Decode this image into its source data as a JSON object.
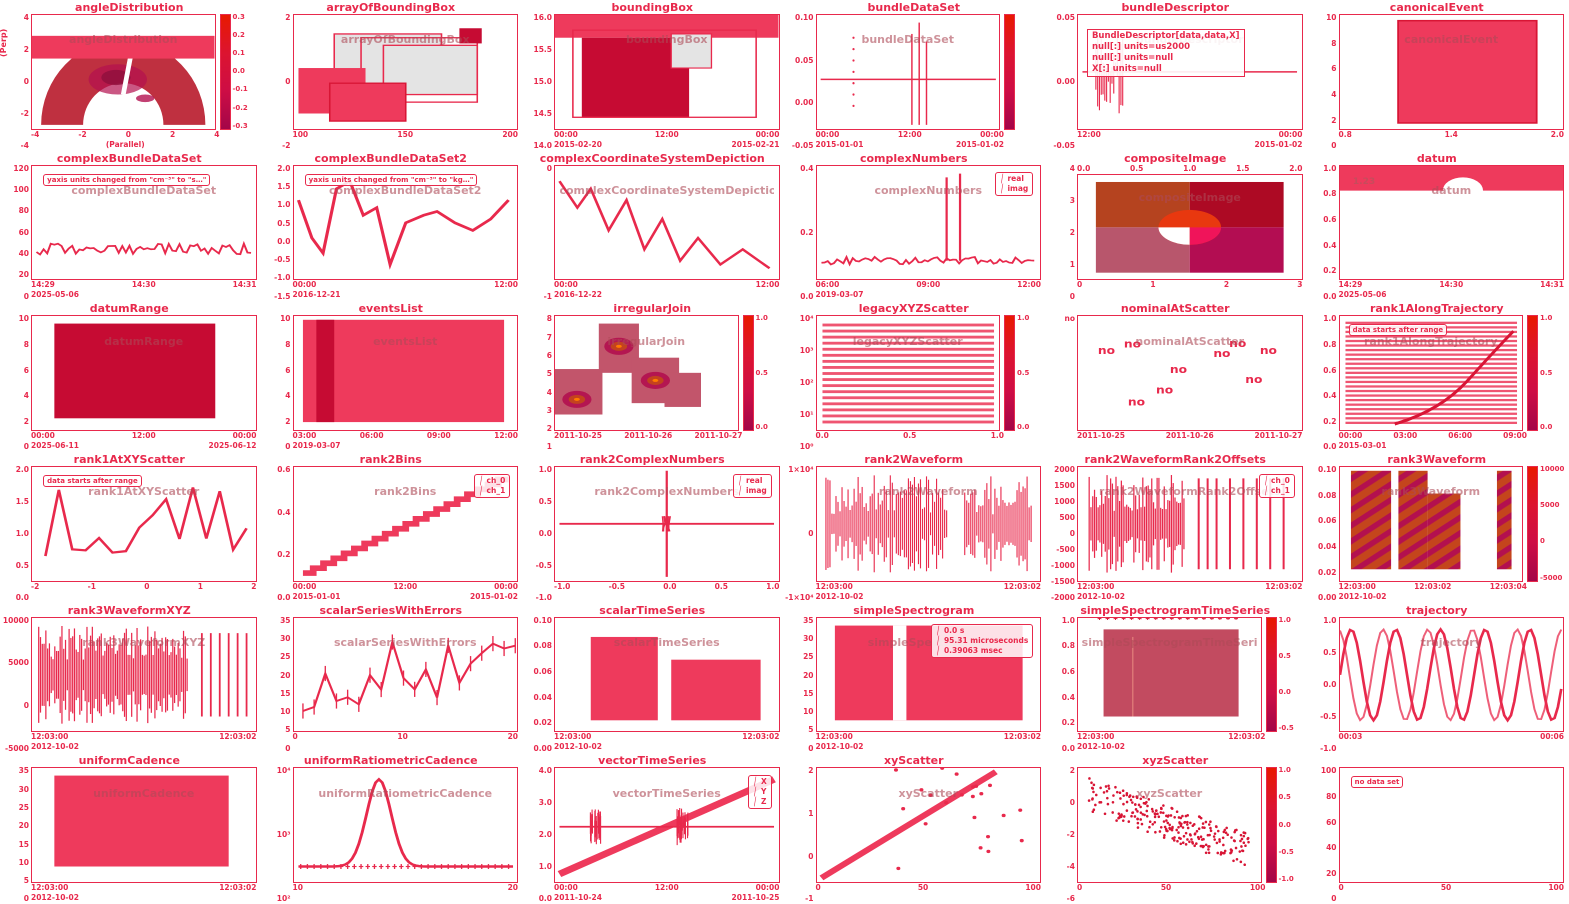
{
  "accent_color": "#e8294c",
  "dark_color": "#c60b33",
  "fill_color": "#ee3a5c",
  "chart_data": [
    {
      "title": "angleDistribution",
      "type": "polar-heatmap",
      "sketch": "fan",
      "ylabel": "(Perp)",
      "xlabel": "(Parallel)",
      "x_ticks": [
        "-4",
        "-2",
        "0",
        "2",
        "4"
      ],
      "y_ticks": [
        "4",
        "2",
        "0",
        "-2",
        "-4"
      ],
      "colorbar_ticks": [
        "0.3",
        "0.2",
        "0.1",
        "0.0",
        "-0.1",
        "-0.2",
        "-0.3"
      ]
    },
    {
      "title": "arrayOfBoundingBox",
      "type": "boxes",
      "sketch": "boxes",
      "x_ticks": [
        "100",
        "150",
        "200"
      ],
      "y_ticks": [
        "2",
        "0",
        "-2"
      ]
    },
    {
      "title": "boundingBox",
      "type": "boxes",
      "sketch": "boxes2",
      "x_ticks": [
        "00:00",
        "12:00",
        "00:00"
      ],
      "dates": [
        "2015-02-20",
        "",
        "2015-02-21"
      ],
      "y_ticks": [
        "16.0",
        "15.5",
        "15.0",
        "14.5",
        "14.0"
      ]
    },
    {
      "title": "bundleDataSet",
      "type": "line",
      "sketch": "flatspikes",
      "x_ticks": [
        "00:00",
        "12:00",
        "00:00"
      ],
      "dates": [
        "2015-01-01",
        "",
        "2015-01-02"
      ],
      "y_ticks": [
        "0.10",
        "0.05",
        "0.00",
        "-0.05"
      ],
      "colorbar_ticks": []
    },
    {
      "title": "bundleDescriptor",
      "type": "text",
      "sketch": "textbox",
      "x_ticks": [
        "12:00",
        "00:00"
      ],
      "dates": [
        "",
        "2015-01-02"
      ],
      "y_ticks": [
        "0.05",
        "0.00",
        "-0.05"
      ],
      "text_lines": [
        "BundleDescriptor[data,data,X]",
        "null[:] units=us2000",
        "null[:] units=null",
        "X[:] units=null"
      ]
    },
    {
      "title": "canonicalEvent",
      "type": "bar",
      "sketch": "bar",
      "x_ticks": [
        "0.8",
        "1.4",
        "2.0"
      ],
      "y_ticks": [
        "10",
        "8",
        "6",
        "4",
        "2",
        "0"
      ]
    },
    {
      "title": "complexBundleDataSet",
      "type": "line",
      "sketch": "noisyflat",
      "annotation": "yaxis units changed from \"cm⁻³\" to \"s…\"",
      "x_ticks": [
        "14:29",
        "14:30",
        "14:31"
      ],
      "dates": [
        "2025-05-06",
        "",
        ""
      ],
      "y_ticks": [
        "120",
        "100",
        "80",
        "60",
        "40",
        "20",
        "0"
      ]
    },
    {
      "title": "complexBundleDataSet2",
      "type": "line",
      "sketch": "zigzag",
      "annotation": "yaxis units changed from \"cm⁻³\" to \"kg…\"",
      "x_ticks": [
        "00:00",
        "12:00"
      ],
      "dates": [
        "2016-12-21",
        ""
      ],
      "y_ticks": [
        "2.0",
        "1.5",
        "1.0",
        "0.5",
        "0.0",
        "-0.5",
        "-1.0",
        "-1.5"
      ]
    },
    {
      "title": "complexCoordinateSystemDepiction",
      "type": "line",
      "sketch": "zigzag2",
      "x_ticks": [
        "00:00",
        "12:00"
      ],
      "dates": [
        "2016-12-22",
        ""
      ],
      "y_ticks": [
        "0",
        "-1"
      ]
    },
    {
      "title": "complexNumbers",
      "type": "line",
      "sketch": "spikes2",
      "legend": [
        "real",
        "imag"
      ],
      "x_ticks": [
        "06:00",
        "09:00",
        "12:00"
      ],
      "dates": [
        "2019-03-07",
        "",
        ""
      ],
      "y_ticks": [
        "0.4",
        "0.2",
        "0.0"
      ]
    },
    {
      "title": "compositeImage",
      "type": "image",
      "sketch": "quadimage",
      "x_ticks_top": [
        "0.0",
        "0.5",
        "1.0",
        "1.5",
        "2.0"
      ],
      "x_ticks": [
        "0",
        "1",
        "2",
        "3"
      ],
      "y_ticks": [
        "4",
        "3",
        "2",
        "1",
        "0"
      ]
    },
    {
      "title": "datum",
      "type": "line",
      "sketch": "datum",
      "value_label": "1.23",
      "x_ticks": [
        "14:29",
        "14:30",
        "14:31"
      ],
      "dates": [
        "2025-05-06",
        "",
        ""
      ],
      "y_ticks": [
        "1.0",
        "0.8",
        "0.6",
        "0.4",
        "0.2",
        "0.0"
      ]
    },
    {
      "title": "datumRange",
      "type": "range",
      "sketch": "bigblock",
      "x_ticks": [
        "00:00",
        "12:00",
        "00:00"
      ],
      "dates": [
        "2025-06-11",
        "",
        "2025-06-12"
      ],
      "y_ticks": [
        "10",
        "8",
        "6",
        "4",
        "2",
        "0"
      ]
    },
    {
      "title": "eventsList",
      "type": "events",
      "sketch": "bigblock2",
      "x_ticks": [
        "03:00",
        "06:00",
        "09:00",
        "12:00"
      ],
      "dates": [
        "2019-03-07",
        "",
        "",
        ""
      ],
      "y_ticks": [
        "10",
        "8",
        "6",
        "4",
        "2",
        "0"
      ]
    },
    {
      "title": "irregularJoin",
      "type": "heatmap",
      "sketch": "contour",
      "x_ticks": [
        "2011-10-25",
        "2011-10-26",
        "2011-10-27"
      ],
      "y_ticks": [
        "8",
        "7",
        "6",
        "5",
        "4",
        "3",
        "2",
        "1"
      ],
      "colorbar_ticks": [
        "1.0",
        "0.5",
        "0.0"
      ]
    },
    {
      "title": "legacyXYZScatter",
      "type": "heatmap",
      "sketch": "hstripes",
      "x_ticks": [
        "0.0",
        "0.5",
        "1.0"
      ],
      "y_ticks": [
        "10⁴",
        "10³",
        "10²",
        "10¹",
        "10⁰"
      ],
      "colorbar_ticks": [
        "1.0",
        "0.5",
        "0.0"
      ]
    },
    {
      "title": "nominalAtScatter",
      "type": "nominal-scatter",
      "sketch": "nolabels",
      "marker_text": "no",
      "x_ticks": [
        "2011-10-25",
        "2011-10-26",
        "2011-10-27"
      ],
      "y_ticks": [
        "no"
      ]
    },
    {
      "title": "rank1AlongTrajectory",
      "type": "heatmap",
      "sketch": "hstripes_curve",
      "annotation": "data starts after range",
      "x_ticks": [
        "00:00",
        "03:00",
        "06:00",
        "09:00"
      ],
      "dates": [
        "2015-03-01",
        "",
        "",
        ""
      ],
      "y_ticks": [
        "1.0",
        "0.8",
        "0.6",
        "0.4",
        "0.2",
        "0.0"
      ],
      "colorbar_ticks": [
        "1.0",
        "0.5",
        "0.0"
      ]
    },
    {
      "title": "rank1AtXYScatter",
      "type": "line",
      "sketch": "randwalk",
      "annotation": "data starts after range",
      "x_ticks": [
        "-2",
        "-1",
        "0",
        "1",
        "2"
      ],
      "y_ticks": [
        "2.0",
        "1.5",
        "1.0",
        "0.5",
        "0.0"
      ]
    },
    {
      "title": "rank2Bins",
      "type": "line",
      "sketch": "staircase",
      "legend": [
        "ch_0",
        "ch_1"
      ],
      "x_ticks": [
        "00:00",
        "12:00",
        "00:00"
      ],
      "dates": [
        "2015-01-01",
        "",
        "2015-01-02"
      ],
      "y_ticks": [
        "0.6",
        "0.4",
        "0.2",
        "0.0"
      ]
    },
    {
      "title": "rank2ComplexNumbers",
      "type": "line",
      "sketch": "crosshair",
      "legend": [
        "real",
        "imag"
      ],
      "x_ticks": [
        "-1.0",
        "-0.5",
        "0.0",
        "0.5",
        "1.0"
      ],
      "y_ticks": [
        "1.0",
        "0.5",
        "0.0",
        "-0.5",
        "-1.0"
      ]
    },
    {
      "title": "rank2Waveform",
      "type": "waveform",
      "sketch": "waveband",
      "x_ticks": [
        "12:03:00",
        "12:03:02"
      ],
      "dates": [
        "2012-10-02",
        ""
      ],
      "y_ticks": [
        "1×10⁴",
        "0",
        "-1×10⁴"
      ]
    },
    {
      "title": "rank2WaveformRank2Offsets",
      "type": "waveform",
      "sketch": "bursts",
      "legend": [
        "ch_0",
        "ch_1"
      ],
      "x_ticks": [
        "12:03:00",
        "12:03:02"
      ],
      "dates": [
        "2012-10-02",
        ""
      ],
      "y_ticks": [
        "2000",
        "1500",
        "1000",
        "500",
        "0",
        "-500",
        "-1000",
        "-1500",
        "-2000"
      ]
    },
    {
      "title": "rank3Waveform",
      "type": "spectrogram",
      "sketch": "diagblocks",
      "x_ticks": [
        "12:03:00",
        "12:03:02",
        "12:03:04"
      ],
      "dates": [
        "2012-10-02",
        "",
        ""
      ],
      "y_ticks": [
        "0.10",
        "0.08",
        "0.06",
        "0.04",
        "0.02",
        "0.00"
      ],
      "colorbar_ticks": [
        "10000",
        "5000",
        "0",
        "-5000"
      ]
    },
    {
      "title": "rank3WaveformXYZ",
      "type": "waveform",
      "sketch": "waveband2",
      "x_ticks": [
        "12:03:00",
        "12:03:02"
      ],
      "dates": [
        "2012-10-02",
        ""
      ],
      "y_ticks": [
        "10000",
        "5000",
        "0",
        "-5000"
      ]
    },
    {
      "title": "scalarSeriesWithErrors",
      "type": "errorbar-line",
      "sketch": "errorline",
      "x_ticks": [
        "0",
        "10",
        "20"
      ],
      "y_ticks": [
        "35",
        "30",
        "25",
        "20",
        "15",
        "10",
        "5",
        "0"
      ]
    },
    {
      "title": "scalarTimeSeries",
      "type": "line",
      "sketch": "steprects",
      "x_ticks": [
        "12:03:00",
        "12:03:02"
      ],
      "dates": [
        "2012-10-02",
        ""
      ],
      "y_ticks": [
        "0.10",
        "0.08",
        "0.06",
        "0.04",
        "0.02",
        "0.00"
      ]
    },
    {
      "title": "simpleSpectrogram",
      "type": "spectrogram",
      "sketch": "blockgap",
      "legend": [
        "0.0 s",
        "95.31 microseconds",
        "0.39063 msec"
      ],
      "x_ticks": [
        "12:03:00",
        "12:03:02"
      ],
      "dates": [
        "2012-10-02",
        ""
      ],
      "y_ticks": [
        "35",
        "30",
        "25",
        "20",
        "15",
        "10",
        "5",
        "0"
      ]
    },
    {
      "title": "simpleSpectrogramTimeSeries",
      "type": "spectrogram",
      "sketch": "gaussblock",
      "x_ticks": [
        "12:03:00",
        "12:03:02"
      ],
      "dates": [
        "2012-10-02",
        ""
      ],
      "y_ticks": [
        "1.0",
        "0.8",
        "0.6",
        "0.4",
        "0.2",
        "0.0"
      ],
      "colorbar_ticks": [
        "1.0",
        "0.5",
        "0.0",
        "-0.5"
      ]
    },
    {
      "title": "trajectory",
      "type": "line",
      "sketch": "sines",
      "x_ticks": [
        "00:03",
        "00:06"
      ],
      "y_ticks": [
        "1.0",
        "0.5",
        "0.0",
        "-0.5",
        "-1.0"
      ]
    },
    {
      "title": "uniformCadence",
      "type": "image",
      "sketch": "block",
      "x_ticks": [
        "12:03:00",
        "12:03:02"
      ],
      "dates": [
        "2012-10-02",
        ""
      ],
      "y_ticks": [
        "35",
        "30",
        "25",
        "20",
        "15",
        "10",
        "5",
        "0"
      ]
    },
    {
      "title": "uniformRatiometricCadence",
      "type": "line",
      "sketch": "gaussmark",
      "x_ticks": [
        "10",
        "20"
      ],
      "y_ticks": [
        "10⁴",
        "10³",
        "10²"
      ]
    },
    {
      "title": "vectorTimeSeries",
      "type": "line",
      "sketch": "diagfuzz",
      "legend": [
        "X",
        "Y",
        "Z"
      ],
      "x_ticks": [
        "00:00",
        "12:00",
        "00:00"
      ],
      "dates": [
        "2011-10-24",
        "",
        "2011-10-25"
      ],
      "y_ticks": [
        "4.0",
        "3.0",
        "2.0",
        "1.0",
        "0.0"
      ]
    },
    {
      "title": "xyScatter",
      "type": "scatter",
      "sketch": "diagscatter",
      "x_ticks": [
        "0",
        "50",
        "100"
      ],
      "y_ticks": [
        "2",
        "1",
        "0",
        "-1"
      ]
    },
    {
      "title": "xyzScatter",
      "type": "scatter",
      "sketch": "cloud",
      "x_ticks": [
        "0",
        "50",
        "100"
      ],
      "y_ticks": [
        "2",
        "0",
        "-2",
        "-4",
        "-6"
      ],
      "colorbar_ticks": [
        "1.0",
        "0.5",
        "0.0",
        "-0.5",
        "-1.0"
      ]
    },
    {
      "title": "",
      "type": "empty",
      "sketch": "empty",
      "annotation": "no data set",
      "x_ticks": [
        "0",
        "50",
        "100"
      ],
      "y_ticks": [
        "100",
        "80",
        "60",
        "40",
        "20",
        "0"
      ]
    }
  ]
}
